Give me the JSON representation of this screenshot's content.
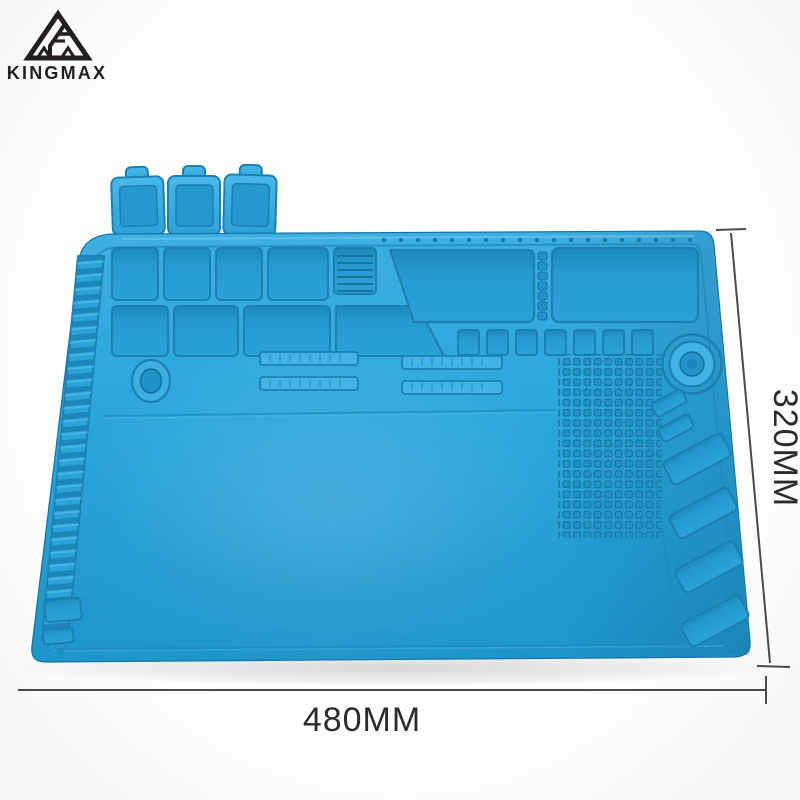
{
  "brand": {
    "wordmark": "KINGMAX",
    "logo_icon": "triangle-f-monogram-icon",
    "logo_color": "#231f20"
  },
  "product": {
    "mat_color": "#29A4D9",
    "groove_color": "#1B81B3",
    "highlight_color": "#66C8EE"
  },
  "annotations": {
    "width_label": "480MM",
    "height_label": "320MM",
    "line_color": "#4a4a4a",
    "text_color": "#2b2b2b"
  }
}
